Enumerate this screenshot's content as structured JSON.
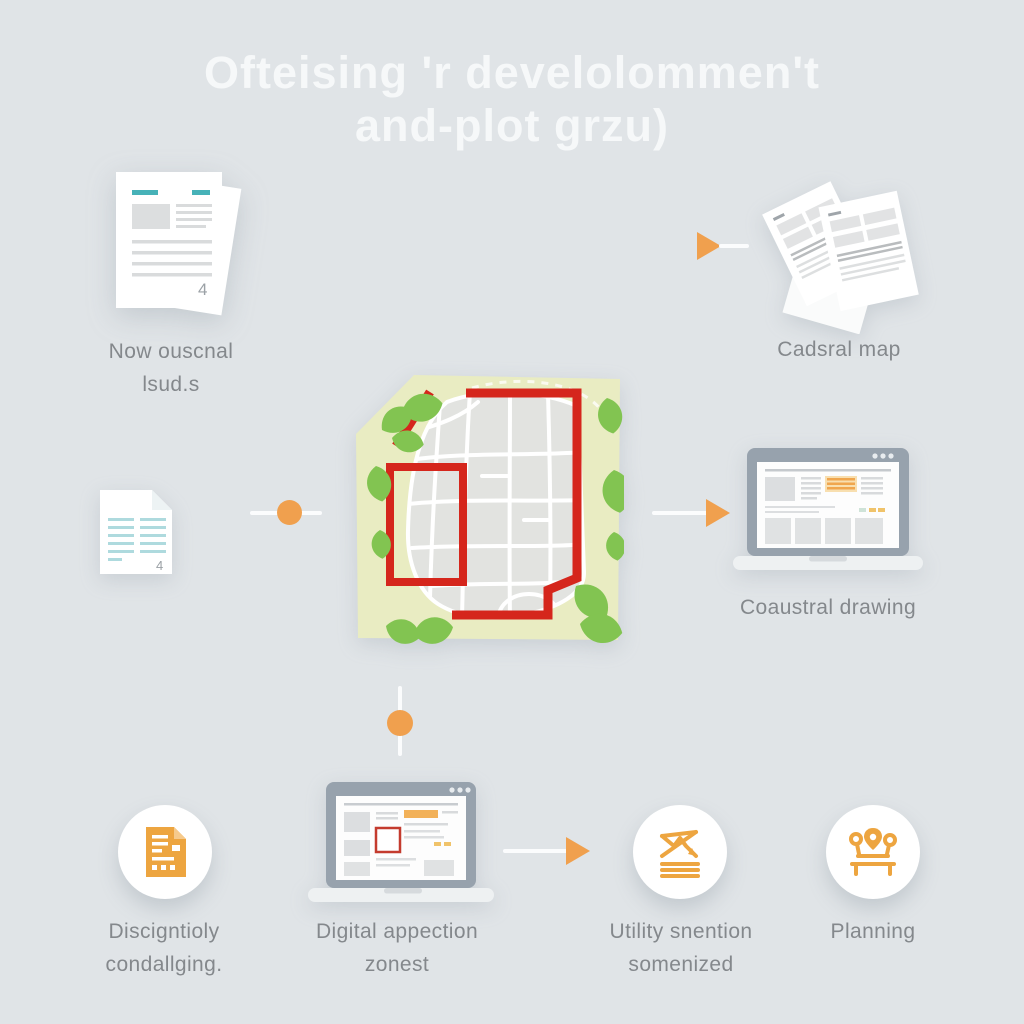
{
  "title": {
    "line1": "Ofteising 'r develolommen't",
    "line2": "and-plot grzu)"
  },
  "labels": {
    "source_docs_1": "Now ouscnal",
    "source_docs_2": "lsud.s",
    "cadastral_map": "Cadsral map",
    "cadastral_drawing": "Coaustral drawing",
    "description_1": "Discigntioly",
    "description_2": "condallging.",
    "digital_1": "Digital appection",
    "digital_2": "zonest",
    "utility_1": "Utility snention",
    "utility_2": "somenized",
    "planning": "Planning"
  },
  "glyphs": {
    "doc_corner": "4"
  },
  "icons": {
    "top_left": "document-stack-icon",
    "top_right": "scattered-documents-icon",
    "center": "cadastral-map-illustration",
    "left_middle": "document-icon",
    "right_middle": "laptop-icon",
    "bottom_1": "form-document-icon",
    "bottom_2": "laptop-icon",
    "bottom_3": "utility-network-icon",
    "bottom_4": "planning-icon",
    "connectors": [
      "arrow-right-icon",
      "dot-connector-icon"
    ]
  },
  "colors": {
    "background": "#e0e4e7",
    "title_text": "#f6f8f9",
    "label_text": "#84888c",
    "accent_orange": "#f0a04e",
    "icon_orange": "#eda540",
    "teal_accent": "#47b2b8",
    "parcel_red": "#d5261c",
    "map_yellow": "#e9ecc2",
    "leaf_green": "#82c451",
    "map_gray": "#e2e3e0",
    "laptop_bezel": "#97a2ad",
    "screen_highlight": "#f0a64e"
  }
}
